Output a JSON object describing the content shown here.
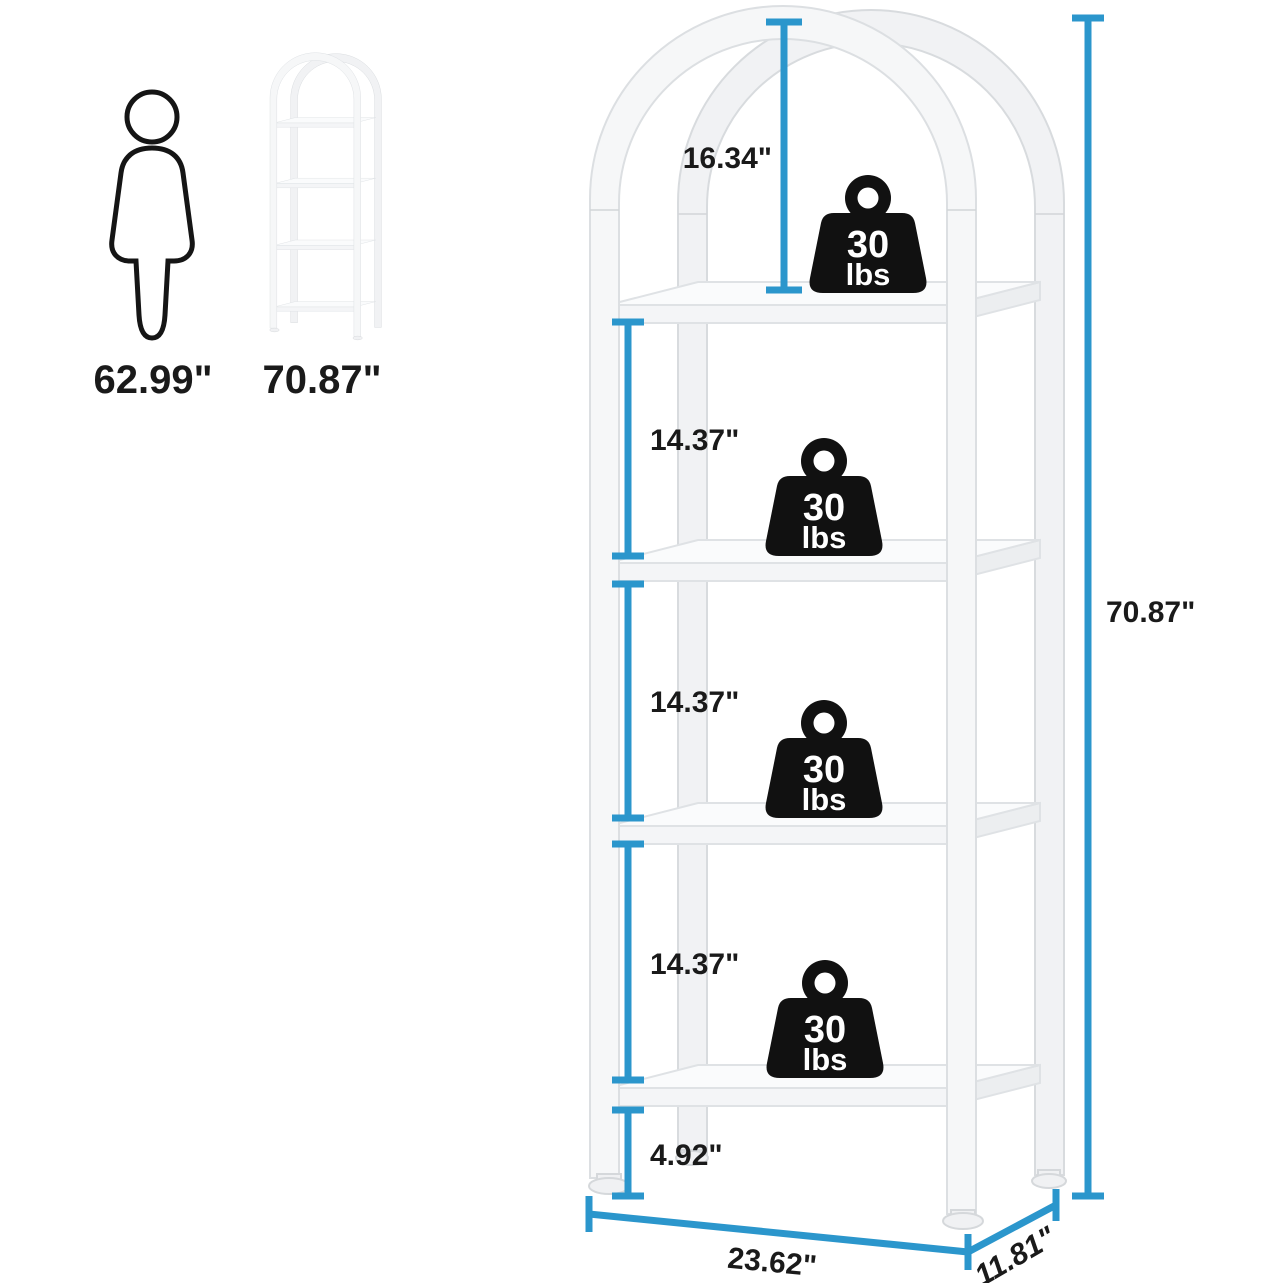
{
  "colors": {
    "dimension_line": "#2B96CC",
    "label_text": "#1a1a1a",
    "weight_icon": "#111111",
    "frame_outline": "#dcdfe2"
  },
  "reference": {
    "person_height": "62.99\"",
    "product_height": "70.87\""
  },
  "dimensions": {
    "top_section": "16.34\"",
    "shelf_gap_1": "14.37\"",
    "shelf_gap_2": "14.37\"",
    "shelf_gap_3": "14.37\"",
    "bottom_clearance": "4.92\"",
    "total_height": "70.87\"",
    "width": "23.62\"",
    "depth": "11.81\""
  },
  "weights": [
    {
      "value": "30",
      "unit": "lbs"
    },
    {
      "value": "30",
      "unit": "lbs"
    },
    {
      "value": "30",
      "unit": "lbs"
    },
    {
      "value": "30",
      "unit": "lbs"
    }
  ]
}
